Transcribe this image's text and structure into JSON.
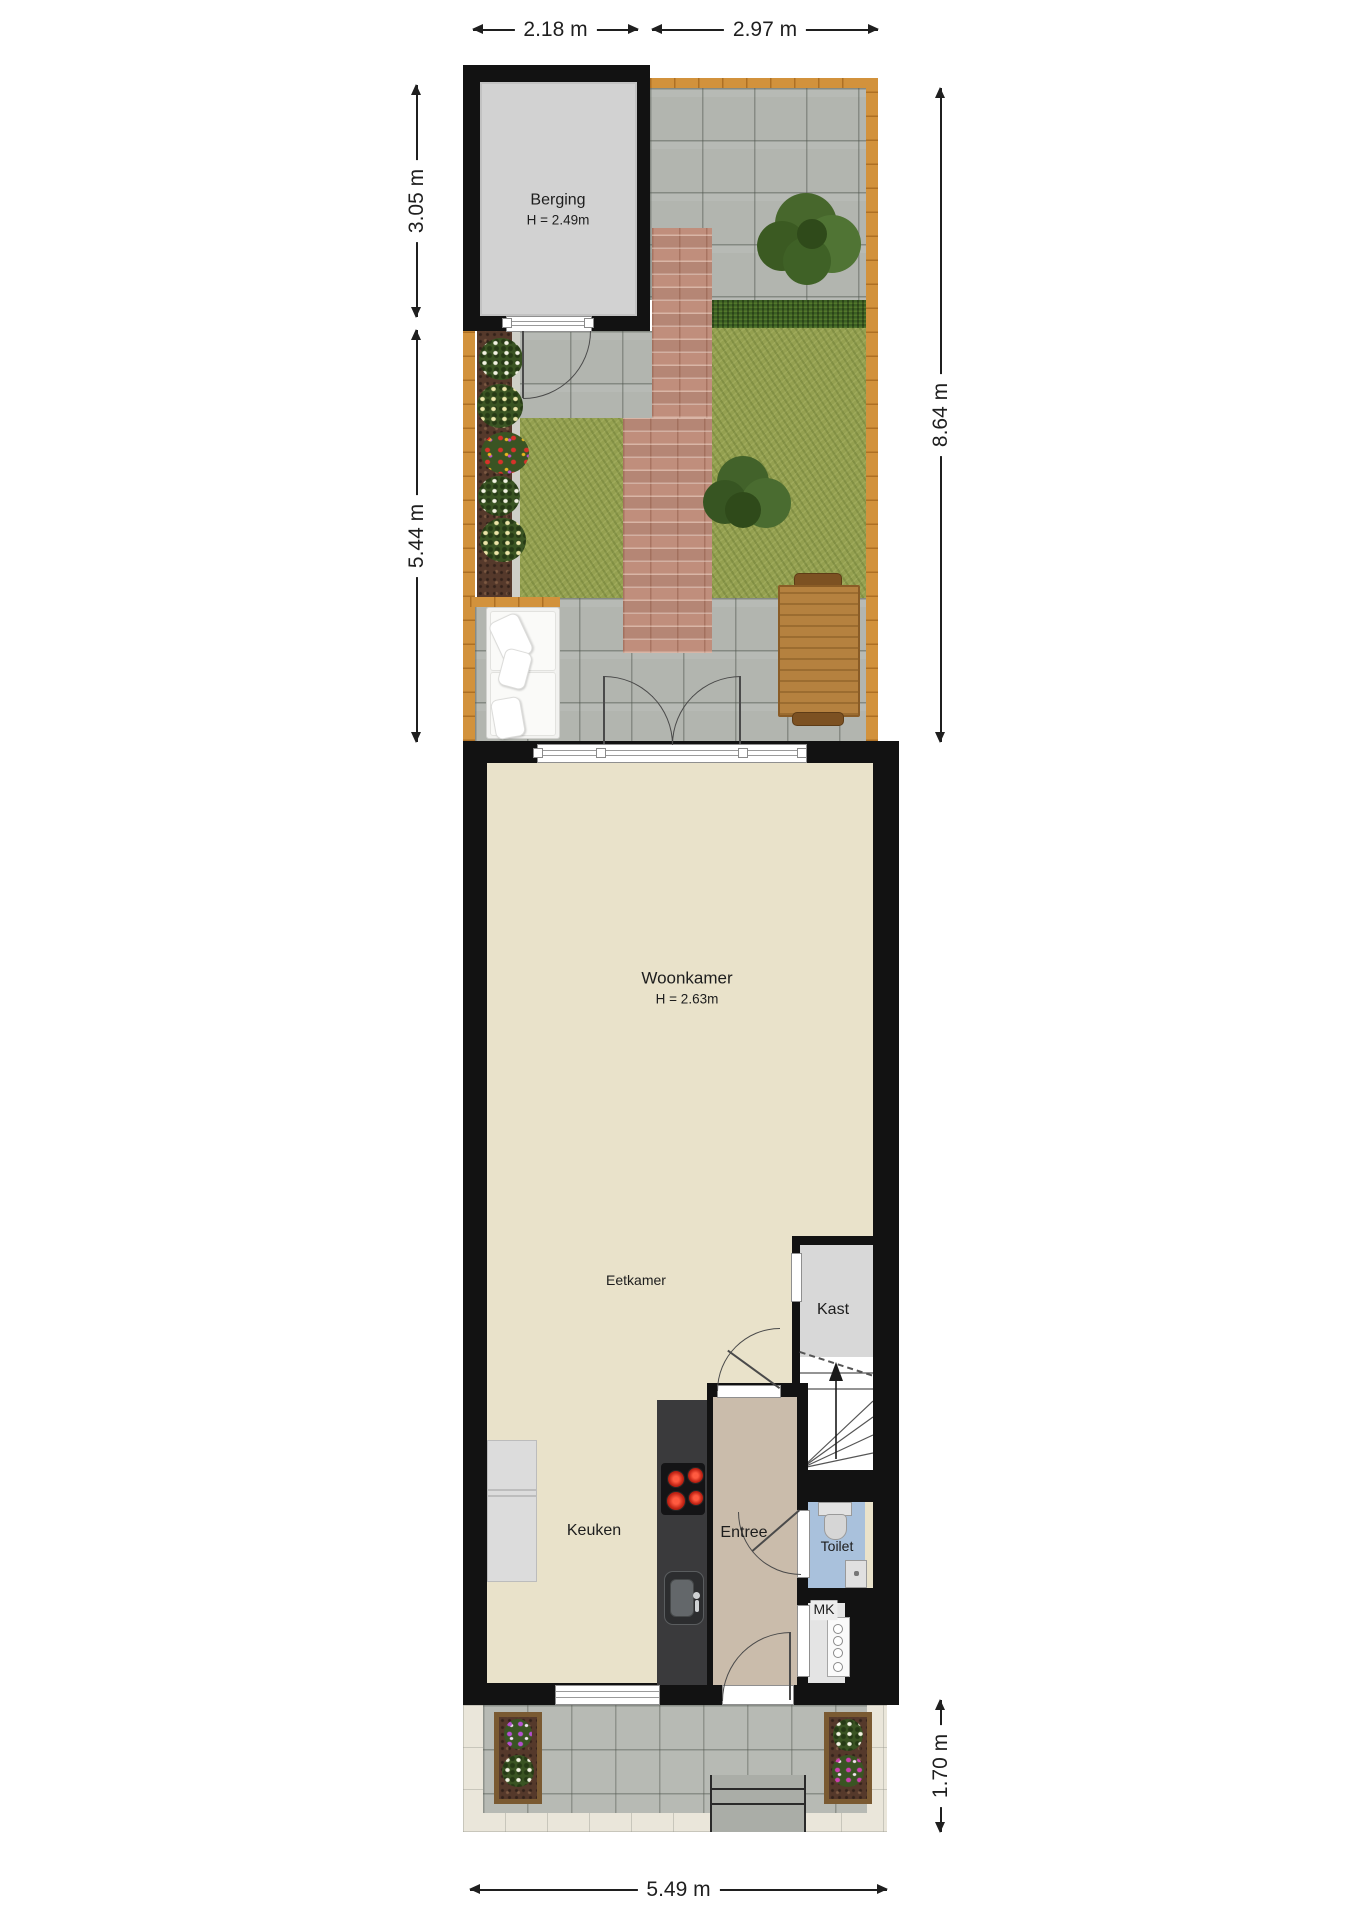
{
  "dimensions": {
    "top_left": "2.18 m",
    "top_right": "2.97 m",
    "left_upper": "3.05 m",
    "left_lower": "5.44 m",
    "right_back": "8.64 m",
    "right_front": "1.70 m",
    "bottom": "5.49 m"
  },
  "rooms": {
    "berging": {
      "label": "Berging",
      "height": "H = 2.49m"
    },
    "woonkamer": {
      "label": "Woonkamer",
      "height": "H = 2.63m"
    },
    "eetkamer": {
      "label": "Eetkamer"
    },
    "kast": {
      "label": "Kast"
    },
    "keuken": {
      "label": "Keuken"
    },
    "entree": {
      "label": "Entree"
    },
    "toilet": {
      "label": "Toilet"
    },
    "mk": {
      "label": "MK"
    }
  },
  "colors": {
    "wall": "#121212",
    "woonkamer_floor": "#e9e2ca",
    "entree_floor": "#cabcab",
    "kast_floor": "#d8d8d8",
    "toilet_floor": "#a9c1dc",
    "berging_floor": "#d2d2d2",
    "counter": "#3a3a3c",
    "pavers": "#b2b5af",
    "pavers_front": "#b7bab4",
    "sidewalk": "#eae6da",
    "grass": "#94a050",
    "hedge": "#3c6023",
    "brick": "#c08e7c",
    "mulch": "#55392b",
    "fence": "#d2923c",
    "burner": "#d32b1e",
    "line": "#4a4a4a",
    "dim": "#1f1f1f"
  }
}
